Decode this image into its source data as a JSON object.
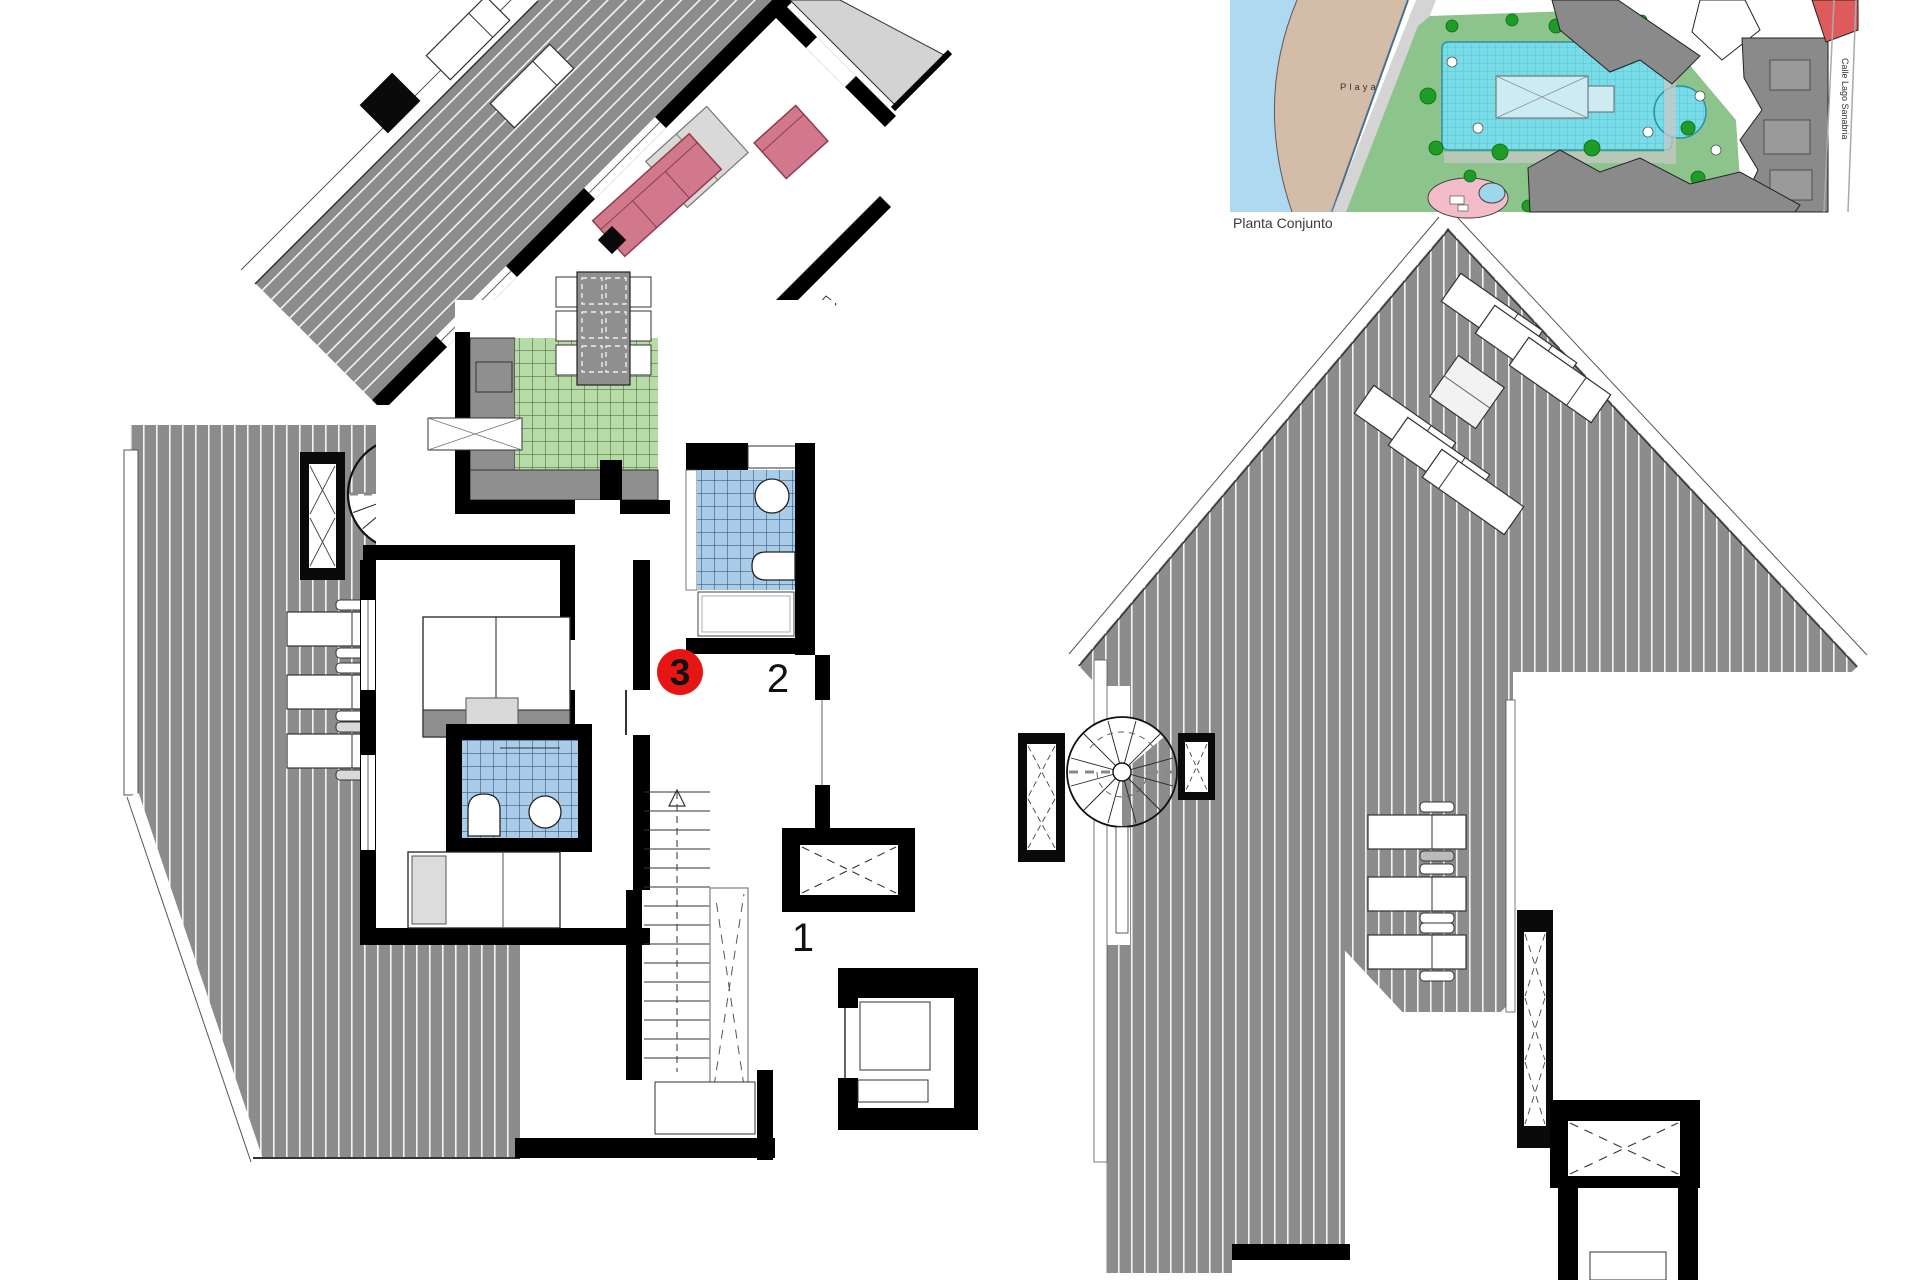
{
  "document": {
    "type": "architectural floor plan sheet",
    "sheets": "penthouse level plan (left, unit 3) and roof terrace plan (right)"
  },
  "labels": {
    "unit_badge": "3",
    "room_upper": "2",
    "room_lower": "1",
    "inset_caption": "Planta Conjunto",
    "beach": "Playa",
    "street": "Calle Lago Sanabria"
  },
  "palette": {
    "deck_gray": "#8C8C8C",
    "wall_black": "#000000",
    "sofa_pink": "#D2788C",
    "kitchen_tile_green": "#B7DBA6",
    "bath_tile_blue": "#A9CDE9",
    "badge_red": "#E81515",
    "sea_blue": "#AED9F0",
    "beach_sand": "#D4BDA8",
    "lawn_green": "#8CC48C",
    "pool_cyan": "#7ADCE6",
    "building_gray": "#8A8A8A",
    "building_red": "#DF5B5B"
  }
}
